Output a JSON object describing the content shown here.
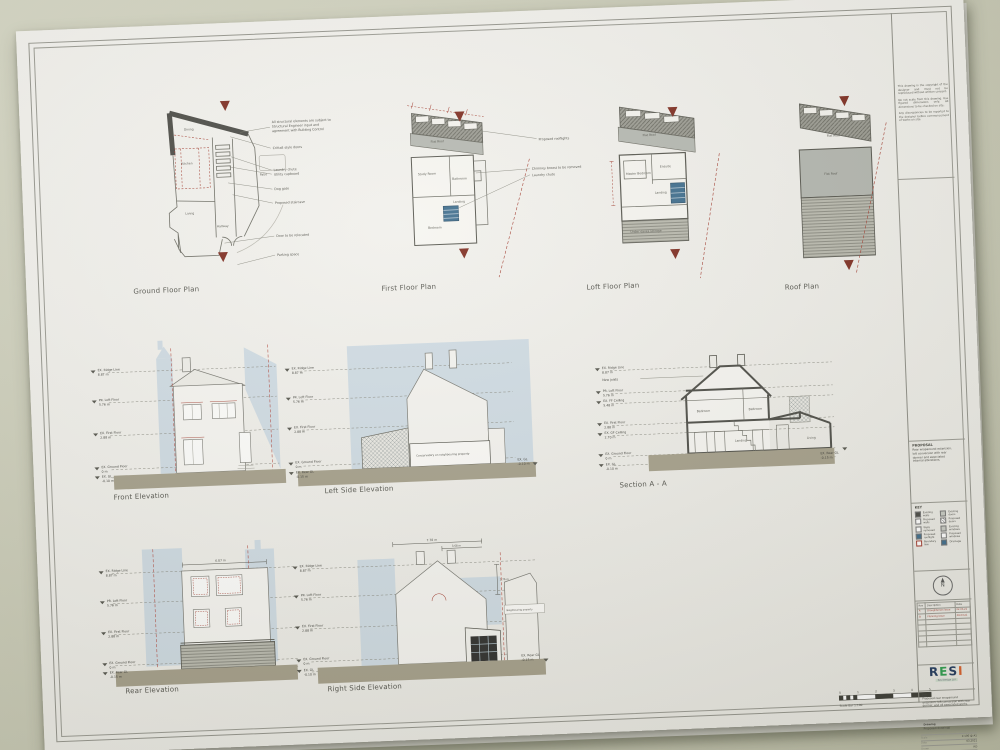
{
  "plans": [
    {
      "title": "Ground Floor Plan",
      "rooms": {
        "dining": "Dining",
        "kitchen": "Kitchen",
        "living": "Living",
        "hallway": "Hallway",
        "patio": "Patio"
      },
      "note_lines": [
        "All structural elements are subject to",
        "Structural Engineer input and",
        "agreement with Building Control"
      ],
      "callouts": [
        "Crittall style doors",
        "Laundry chute",
        "Utility cupboard",
        "Dog gate",
        "Proposed staircase",
        "Door to be relocated",
        "Parking space"
      ]
    },
    {
      "title": "First Floor Plan",
      "rooms": {
        "flat_roof": "Flat Roof",
        "study": "Study Room",
        "bathroom": "Bathroom",
        "landing": "Landing",
        "bedroom": "Bedroom"
      },
      "callouts": [
        "Proposed rooflights",
        "Chimney breast to be removed",
        "Laundry chute"
      ]
    },
    {
      "title": "Loft Floor Plan",
      "rooms": {
        "flat_roof": "Flat Roof",
        "master": "Master Bedroom",
        "ensuite": "Ensuite",
        "landing": "Landing",
        "storage": "Under eaves storage"
      }
    },
    {
      "title": "Roof Plan",
      "rooms": {
        "flat_roof_top": "Flat Roof",
        "flat_roof_main": "Flat Roof"
      }
    }
  ],
  "levels": {
    "ridge": {
      "label": "EX. Ridge Line",
      "value": "8.87 m"
    },
    "loft": {
      "label": "PR. Loft Floor",
      "value": "5.76 m"
    },
    "ff_ceiling": {
      "label": "EX. FF Ceiling",
      "value": "5.48 m"
    },
    "first": {
      "label": "EX. First Floor",
      "value": "2.88 m"
    },
    "gf_ceiling": {
      "label": "EX. GF Ceiling",
      "value": "2.70 m"
    },
    "ground": {
      "label": "EX. Ground Floor",
      "value": "0 m"
    },
    "gl": {
      "label": "EX. GL",
      "value": "-0.10 m"
    },
    "rear_gl": {
      "label": "EX. Rear GL",
      "value": "-0.15 m"
    }
  },
  "elevations": {
    "front": {
      "title": "Front Elevation"
    },
    "left": {
      "title": "Left Side Elevation",
      "note": "Conservatory on neighbouring property"
    },
    "section": {
      "title": "Section A - A",
      "joists_note": "New joists",
      "rooms": {
        "bedroom1": "Bedroom",
        "bedroom2": "Bedroom",
        "landing": "Landing",
        "living": "Living"
      }
    },
    "rear": {
      "title": "Rear Elevation",
      "width_dim": "6.87 m"
    },
    "right": {
      "title": "Right Side Elevation",
      "width_dim": "7.78 m",
      "inner_dim": "3.68 m",
      "height_dim": "2.76 m",
      "note": "Neighbouring property"
    }
  },
  "title_block": {
    "notes": [
      "This drawing is the copyright of the designer and must not be reproduced without written consent.",
      "Do not scale from this drawing. Use figured dimensions only. All dimensions to be checked on site.",
      "Any discrepancies to be reported to the designer before commencement of works on site."
    ],
    "proposal_heading": "PROPOSAL",
    "proposal_lines": [
      "Rear wraparound extension,",
      "loft conversion with rear",
      "dormer and associated",
      "internal alterations."
    ],
    "key": {
      "title": "KEY",
      "left": [
        "Existing walls",
        "Proposed walls",
        "Walls removed",
        "Proposed rooflight",
        "Boundary line"
      ],
      "right": [
        "Existing doors",
        "Proposed doors",
        "Existing windows",
        "Proposed windows",
        "Drainage"
      ]
    },
    "north_label": "N",
    "revisions": {
      "headers": [
        "Rev",
        "Description",
        "Date"
      ],
      "rows": [
        [
          "A",
          "Draughtsman issue",
          "02.03.21"
        ],
        [
          "B",
          "Planning issue",
          "09.03.21"
        ]
      ]
    },
    "logo": {
      "l1": "R",
      "l2": "E",
      "l3": "S",
      "l4": "I",
      "tagline": "Resi Design Ltd"
    },
    "job_label": "Job",
    "job_text": "Proposed rear wraparound extension, loft conversion with rear dormer, and all associated works.",
    "drawing_label": "Drawing",
    "drawing_text": "Proposed drawings",
    "fields": [
      [
        "Scale",
        "1:100 @ A1"
      ],
      [
        "Date",
        "03.2021"
      ],
      [
        "Drawn",
        "RD"
      ],
      [
        "Dwg No",
        "P_200"
      ],
      [
        "Rev",
        "B"
      ]
    ]
  },
  "scale_bar": {
    "numbers": [
      "0",
      "1",
      "2",
      "3",
      "4",
      "5"
    ],
    "label": "Scale Bar 1:100"
  }
}
